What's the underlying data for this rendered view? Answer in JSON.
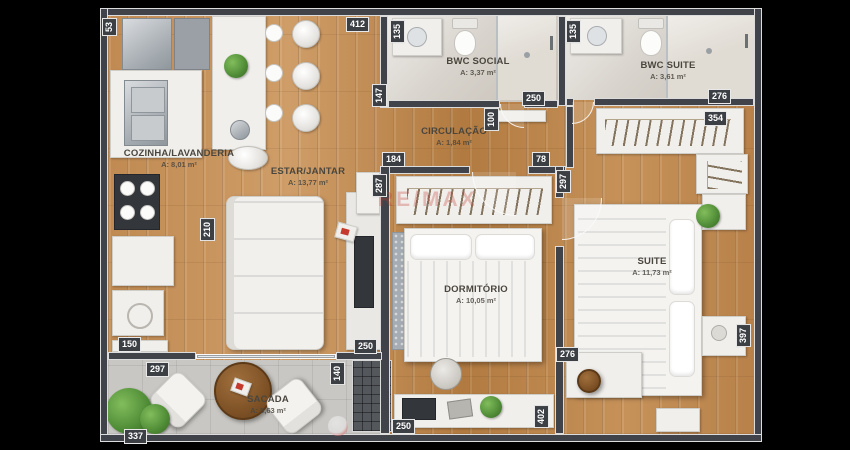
{
  "watermark": "RE/MAX",
  "rooms": {
    "kitchen": {
      "name": "COZINHA/LAVANDERIA",
      "area": "A: 8,01 m²"
    },
    "living": {
      "name": "ESTAR/JANTAR",
      "area": "A: 13,77 m²"
    },
    "circulation": {
      "name": "CIRCULAÇÃO",
      "area": "A: 1,84 m²"
    },
    "bwc_social": {
      "name": "BWC SOCIAL",
      "area": "A: 3,37 m²"
    },
    "bwc_suite": {
      "name": "BWC SUITE",
      "area": "A: 3,61 m²"
    },
    "bedroom": {
      "name": "DORMITÓRIO",
      "area": "A: 10,05 m²"
    },
    "suite": {
      "name": "SUITE",
      "area": "A: 11,73 m²"
    },
    "balcony": {
      "name": "SACADA",
      "area": "A: 5,63 m²"
    }
  },
  "dims": {
    "kitchen_top": "53",
    "top_width": "412",
    "social_vanity": "135",
    "social_door": "250",
    "social_wall": "147",
    "circ_opening": "100",
    "suitebath_vanity": "135",
    "suitebath_width": "276",
    "closet_width": "354",
    "dorm_door_left": "184",
    "dorm_door_right": "78",
    "dorm_wall_left": "287",
    "suite_entry": "297",
    "kitchen_counter": "210",
    "laundry_width": "150",
    "balcony_depth": "297",
    "balcony_width": "337",
    "shaft_width": "140",
    "living_door": "250",
    "desk_width": "250",
    "dorm_bottom": "276",
    "suite_desk": "402",
    "suite_depth": "397"
  },
  "colors": {
    "wall": "#40444a",
    "wood_floor": "#bf8a54",
    "marble_floor": "#d8d3cc",
    "tile_floor": "#c8c7c3",
    "furniture_white": "#f0efec",
    "plant_green": "#4f8c36",
    "watermark_red": "#c43b2e",
    "tag_text": "#ffffff",
    "label_text": "#4a463e"
  }
}
